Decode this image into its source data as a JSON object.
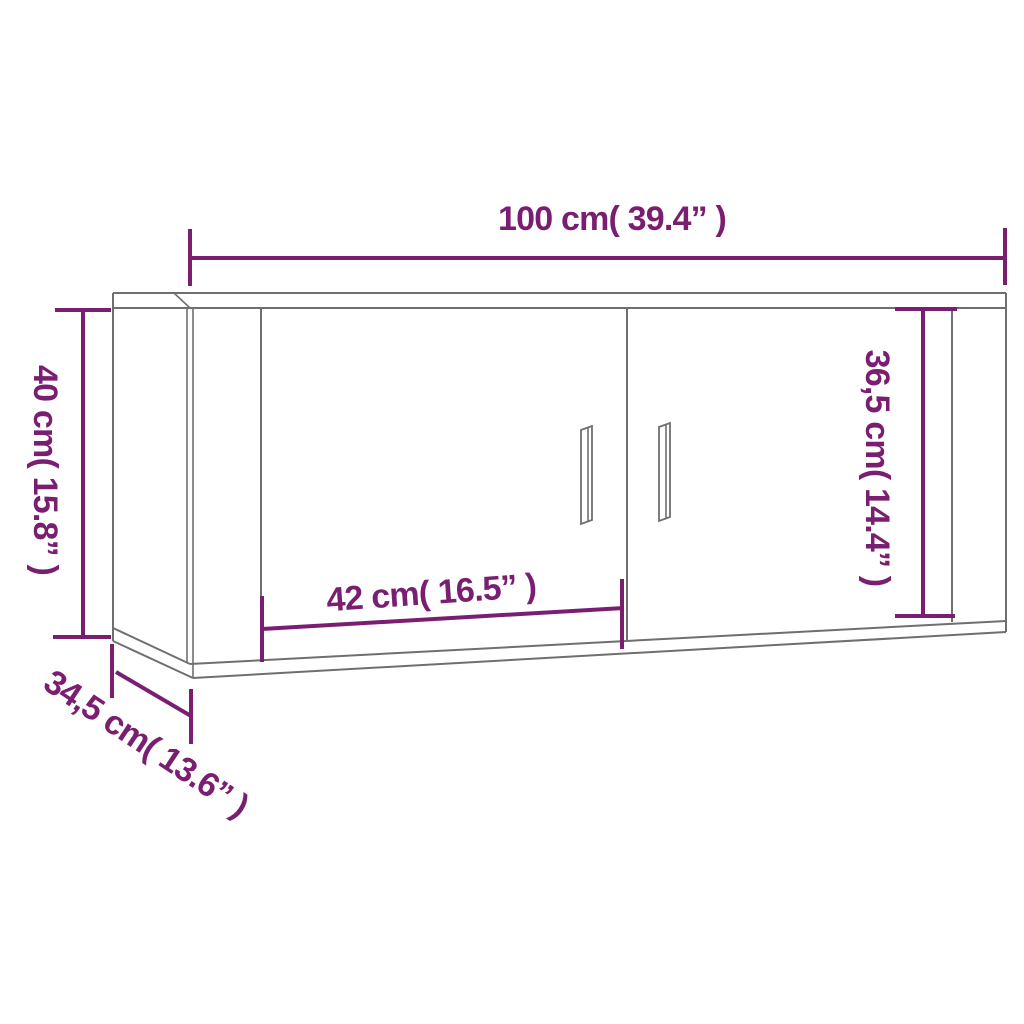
{
  "diagram": {
    "kind": "furniture-dimension-drawing",
    "dimensions": {
      "width": {
        "label": "100 cm( 39.4” )",
        "cm": 100,
        "inches": 39.4
      },
      "height": {
        "label": "40 cm( 15.8” )",
        "cm": 40,
        "inches": 15.8
      },
      "depth": {
        "label": "34,5 cm( 13.6” )",
        "cm": 34.5,
        "inches": 13.6
      },
      "door_width": {
        "label": "42 cm( 16.5” )",
        "cm": 42,
        "inches": 16.5
      },
      "door_height": {
        "label": "36,5 cm( 14.4” )",
        "cm": 36.5,
        "inches": 14.4
      }
    }
  },
  "colors": {
    "accent": "#7a1e71",
    "outline": "#6f6f6f",
    "background": "#ffffff"
  }
}
